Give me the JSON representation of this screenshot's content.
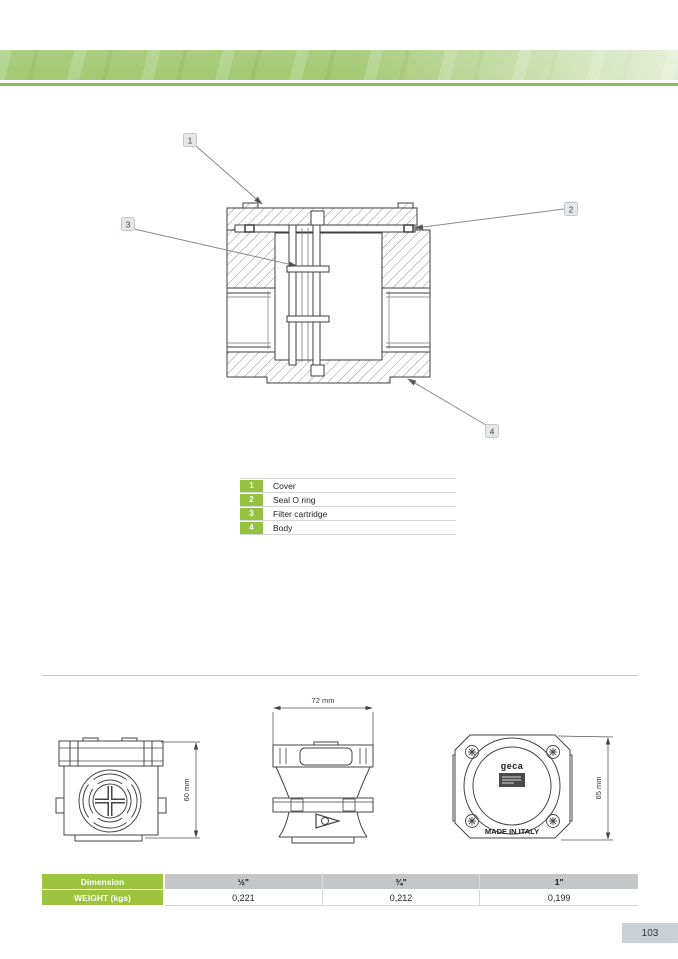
{
  "parts": [
    {
      "num": "1",
      "label": "Cover"
    },
    {
      "num": "2",
      "label": "Seal O ring"
    },
    {
      "num": "3",
      "label": "Filter cartridge"
    },
    {
      "num": "4",
      "label": "Body"
    }
  ],
  "drawings": {
    "front_height": "60 mm",
    "side_width": "72 mm",
    "top_height": "65 mm",
    "logo": "geca",
    "made_in": "MADE IN ITALY"
  },
  "spec_table": {
    "dimension_label": "Dimension",
    "weight_label": "WEIGHT (kgs)",
    "sizes": [
      "½\"",
      "¾\"",
      "1\""
    ],
    "weights": [
      "0,221",
      "0,212",
      "0,199"
    ]
  },
  "footer": {
    "page_number": "103"
  },
  "colors": {
    "accent_green": "#9cc43e",
    "legend_green": "#95c23e",
    "banner_green": "#a9cd7d",
    "banner_rule_green": "#8cbe56",
    "table_header_gray": "#c5c6c8",
    "page_number_bg": "#c9d1d6"
  }
}
